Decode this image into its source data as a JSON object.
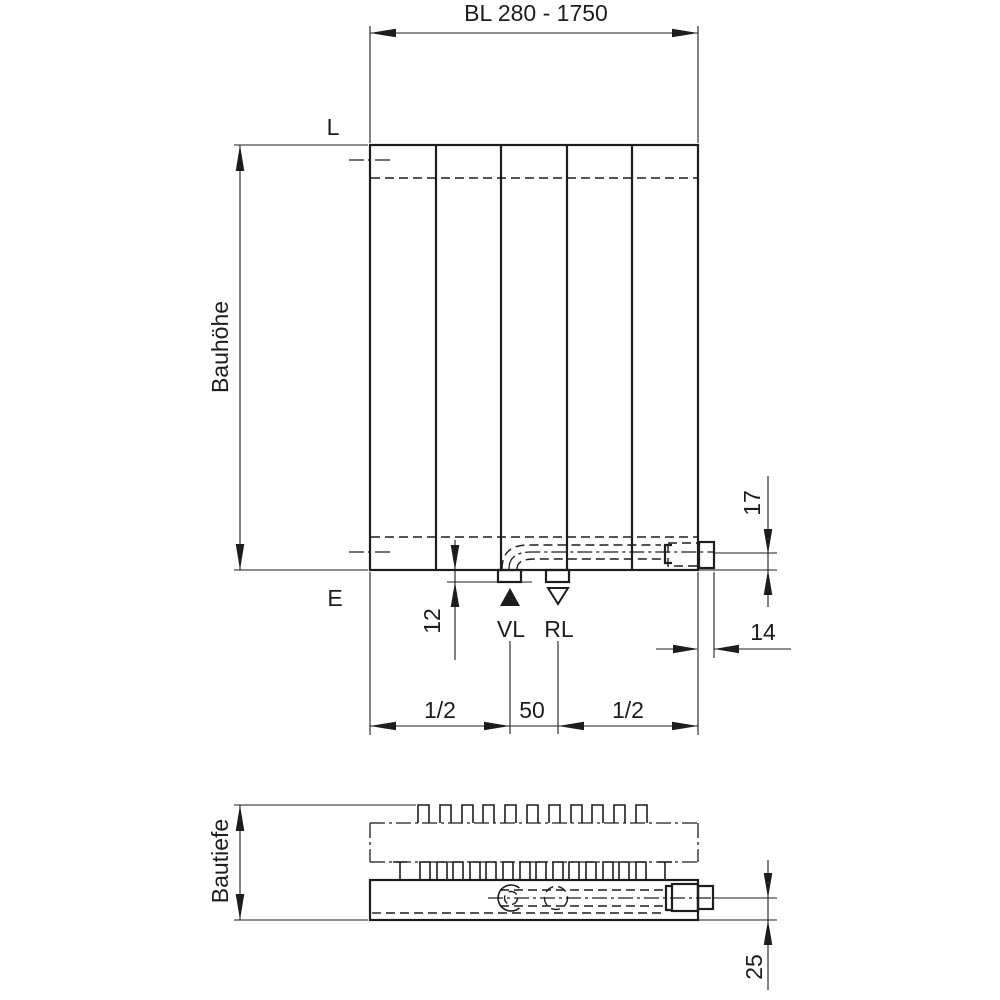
{
  "front_view": {
    "length_dimension": "BL 280 - 1750",
    "height_dimension_label": "Bauhöhe",
    "top_reference_label": "L",
    "bottom_reference_label": "E",
    "supply_connection_label": "VL",
    "return_connection_label": "RL",
    "connection_stub_depth": "12",
    "pipe_axis_to_bottom": "17",
    "side_outlet_offset": "14",
    "connection_spacing": "50",
    "left_half_span": "1/2",
    "right_half_span": "1/2"
  },
  "bottom_view": {
    "depth_dimension_label": "Bautiefe",
    "pipe_axis_to_front": "25"
  },
  "colors": {
    "line": "#1d1d1b",
    "background": "#ffffff"
  }
}
